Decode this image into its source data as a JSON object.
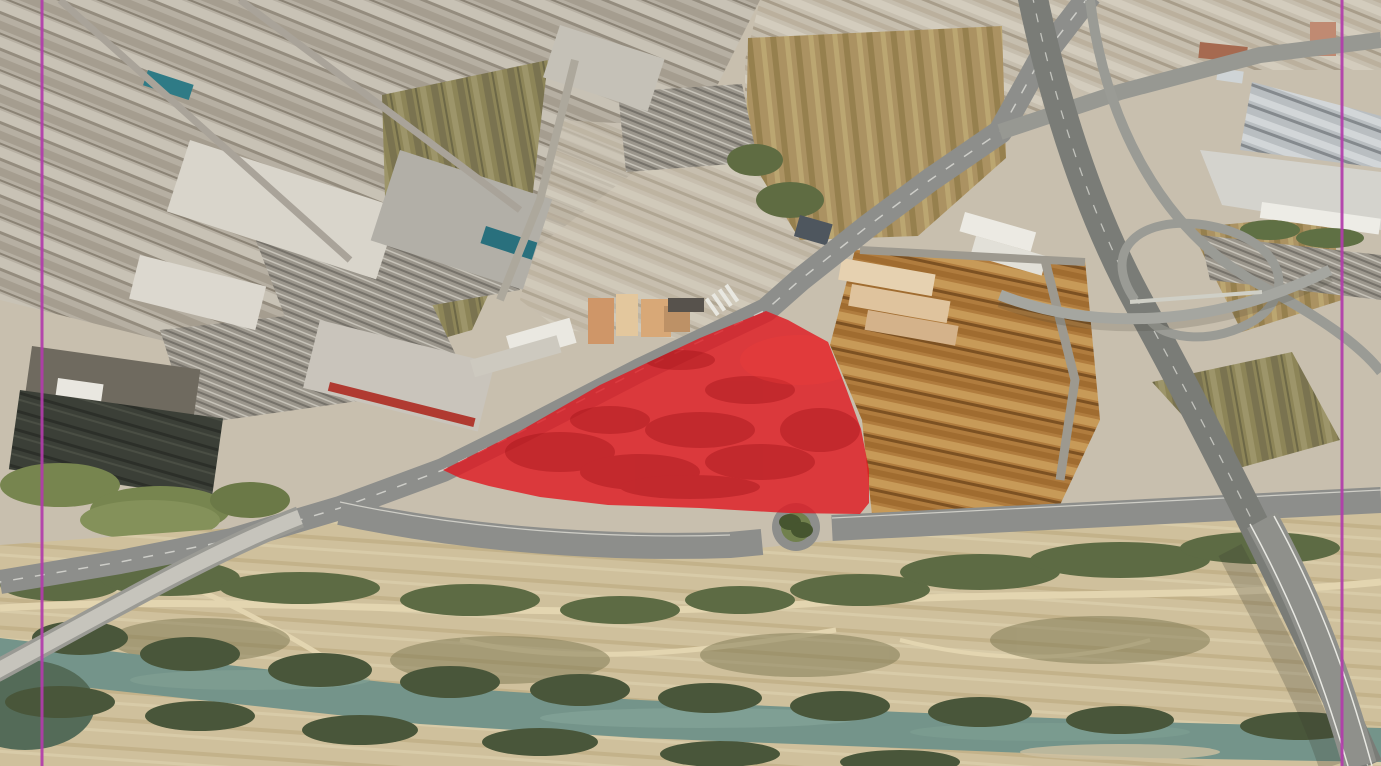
{
  "view": {
    "name": "oblique-aerial-satellite-view",
    "width": 1381,
    "height": 766,
    "description": "3D oblique aerial imagery of an industrial riverside district with a vacant parcel highlighted by a red polygon and two vertical magenta guide lines near the left and right edges"
  },
  "colors": {
    "land_base": "#c8bfae",
    "road": "#8d8e8b",
    "highway": "#7a7c77",
    "viaduct": "#8f908b",
    "bridge_deck": "#c6c4bc",
    "river_water": "#74948a",
    "river_highlight": "#8fae9f",
    "stagnant_pool": "#546b58",
    "sand": "#cfc09c",
    "dirt_path": "#e3d5b0",
    "vegetation_strip": "#5d6b44",
    "riverbank_trees": "#49563a",
    "scrub_olive": "#8d8558",
    "scrub_tan": "#ab9262",
    "roof_white": "#d9d5cb",
    "roof_gray": "#b2afa7",
    "roof_brown": "#b07c3e",
    "roof_teal": "#2f7b86",
    "roof_red_accent": "#b03a31",
    "apartment_terracotta": "#d8a877",
    "basin_dark": "#3b3f37",
    "roundabout_green": "#71804d"
  },
  "overlay": {
    "parcel": {
      "label": "highlighted-parcel",
      "points": "443,470 520,431 600,385 700,338 766,311 788,320 806,330 828,342 846,388 861,429 869,470 869,503 860,514 788,513 700,508 608,505 540,497 489,486 460,478",
      "fill": "#e0181f",
      "opacity": "0.8",
      "mottle_color": "#9c1016"
    }
  },
  "guides": {
    "color": "#b23cab",
    "width": "3",
    "left": {
      "label": "guide-line-left",
      "x": "42"
    },
    "right": {
      "label": "guide-line-right",
      "x": "1342"
    }
  },
  "features": [
    {
      "name": "industrial-district-northwest",
      "kind": "warehouse rooftops"
    },
    {
      "name": "retail-park",
      "kind": "big-box stores with parking lots"
    },
    {
      "name": "water-treatment-basins",
      "kind": "dark rectangular basins"
    },
    {
      "name": "central-brownfield",
      "kind": "cleared industrial lots"
    },
    {
      "name": "warehouse-district-east",
      "kind": "terracotta roofed warehouses"
    },
    {
      "name": "apartment-blocks",
      "kind": "mid-rise residential"
    },
    {
      "name": "shopping-mall-east",
      "kind": "gabled gray roof rows"
    },
    {
      "name": "highway-interchange",
      "kind": "ramps and flyover"
    },
    {
      "name": "riverside-park",
      "kind": "dry riverbed scrub with paths"
    },
    {
      "name": "river",
      "kind": "green-teal watercourse"
    },
    {
      "name": "road-bridge-southwest",
      "kind": "bridge over river"
    },
    {
      "name": "highway-viaduct-southeast",
      "kind": "elevated highway over river"
    },
    {
      "name": "roundabout",
      "kind": "tree-filled traffic circle"
    },
    {
      "name": "highlighted-parcel",
      "kind": "red polygon annotation over vacant lot"
    }
  ]
}
